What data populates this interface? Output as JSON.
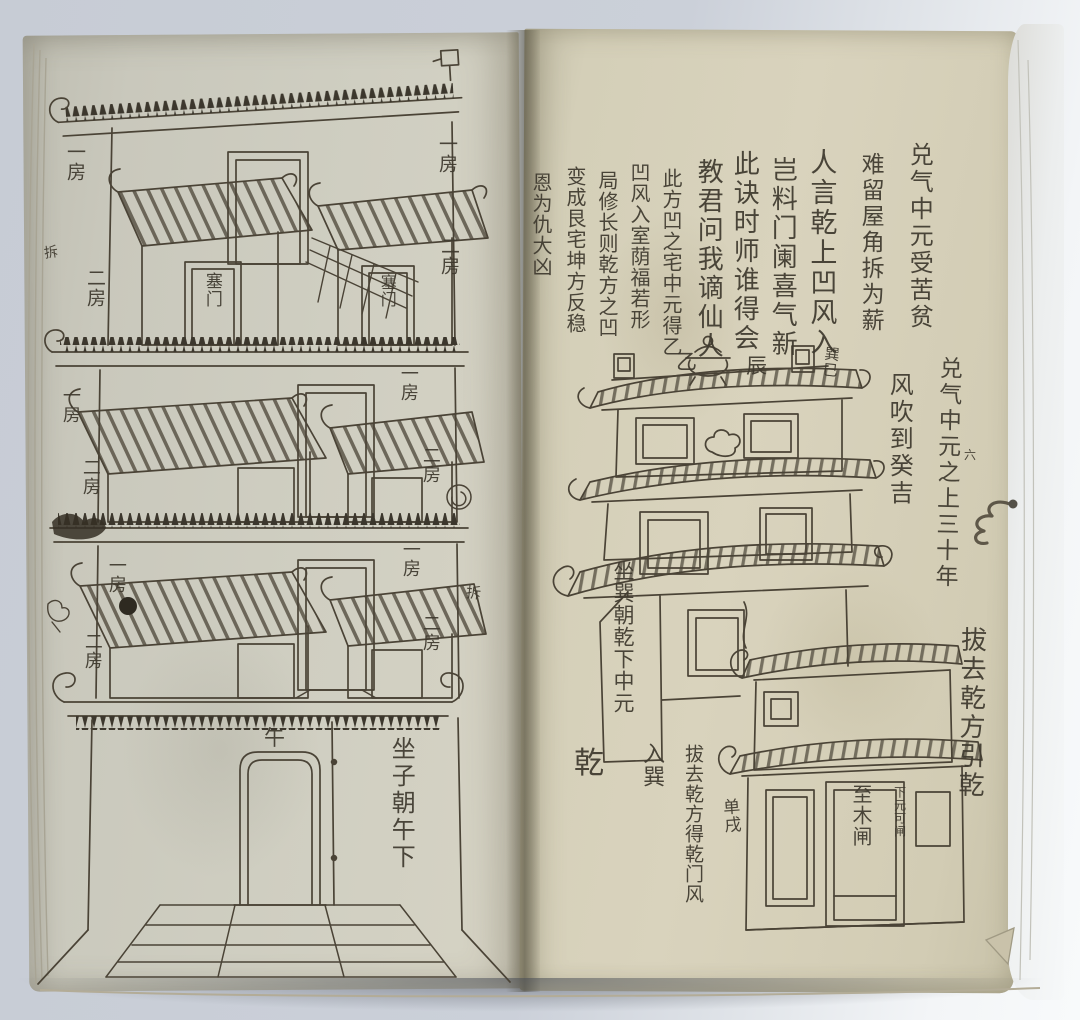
{
  "colors": {
    "backdrop": "#c7ccd5",
    "backdrop_highlight": "#f8fafb",
    "left_page": "#cfcec1",
    "right_page": "#d9d3bd",
    "ink": "#3f3a2f",
    "drawing_stroke": "#4a4336",
    "gutter_shadow": "#55503c"
  },
  "right_page": {
    "margin_columns": [
      {
        "text": "兑气中元受苦贫"
      },
      {
        "text": "难留屋角拆为薪"
      },
      {
        "text": "兑气中元之上三十年"
      },
      {
        "text": "风吹到癸吉"
      },
      {
        "text": "拔去乾方引乾"
      }
    ],
    "verse_columns": [
      "人言乾上凹风入",
      "岂料门阑喜气新",
      "此诀时师谁得会",
      "教君问我谪仙人",
      "此方凹之宅中元得乙",
      "凹风入室荫福若形",
      "局修长则乾方之凹",
      "变成艮宅坤方反稳",
      "恩为仇大凶"
    ],
    "building_labels": {
      "ridge_left": "乙",
      "ridge_right": "辰",
      "ridge_corner": "巽巳",
      "margin_mark": "六",
      "wall_text": "坐巽朝乾下中元",
      "trigram": "乾",
      "enter": "入巽",
      "note_column": "拔去乾方得乾门风",
      "door_side": "单戌",
      "door_label": "至木闸",
      "door_note": "下元可闸"
    }
  },
  "left_page": {
    "floors": [
      {
        "left_top": "一房",
        "left_side": "二房",
        "left_door": "塞门",
        "right_top": "一房",
        "right_side": "二房",
        "right_door": "塞门"
      },
      {
        "left_top": "一房",
        "left_side": "二房",
        "right_top": "一房",
        "right_side": "二房"
      },
      {
        "left_top": "一房",
        "left_side": "二房",
        "right_top": "一房",
        "right_side": "二房"
      }
    ],
    "bottom": {
      "gate": "午",
      "caption": "坐子朝午下"
    },
    "margin_notes": [
      {
        "text": "拆"
      },
      {
        "text": "拆"
      }
    ]
  }
}
